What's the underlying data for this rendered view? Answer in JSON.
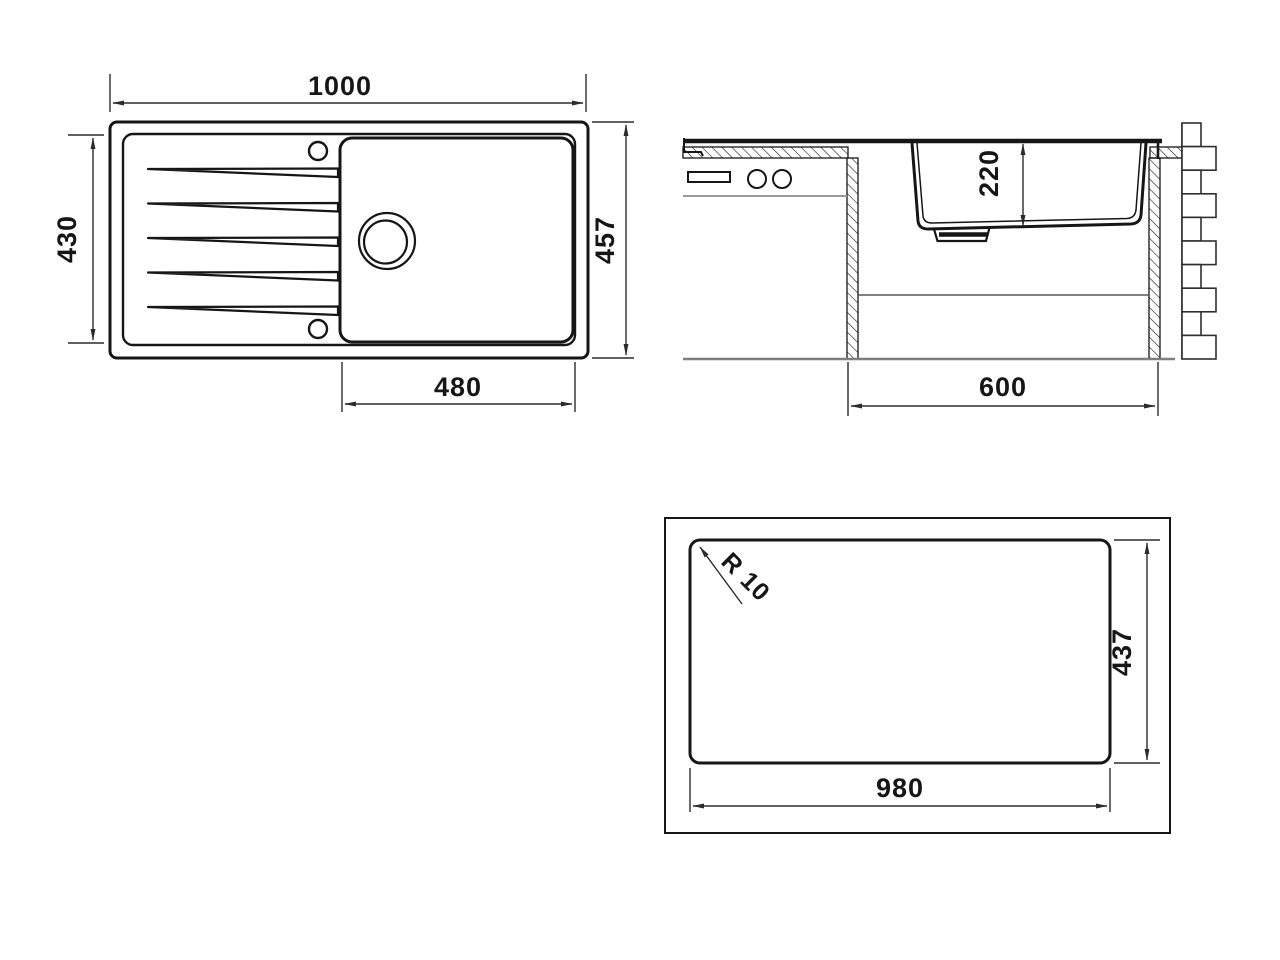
{
  "title": "Kitchen sink installation drawing",
  "colors": {
    "line": "#161616",
    "dim_line": "#2b2b2b",
    "gray_floor": "#7f7f7f",
    "gray_drawer": "#9a9a9a",
    "gray_shelf": "#555555",
    "background": "#ffffff"
  },
  "views": {
    "top_view": {
      "label": "sink-top-view",
      "overall_width_mm": "1000",
      "drainer_length_mm": "430",
      "overall_depth_mm": "457",
      "bowl_width_mm": "480"
    },
    "section_view": {
      "label": "sink-cross-section",
      "bowl_depth_mm": "220",
      "cabinet_width_mm": "600"
    },
    "cutout_view": {
      "label": "worktop-cutout-template",
      "corner_radius": "R 10",
      "cutout_depth_mm": "437",
      "cutout_width_mm": "980"
    }
  }
}
